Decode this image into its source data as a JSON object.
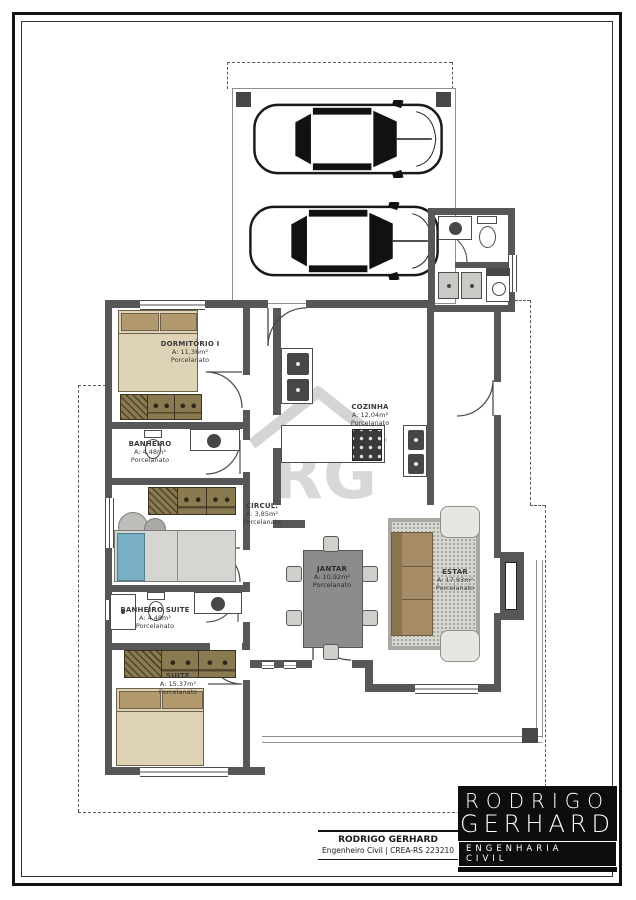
{
  "rooms": [
    {
      "name": "DORMITÓRIO I",
      "area": "A: 11,36m²",
      "floor": "Porcelanato"
    },
    {
      "name": "BANHEIRO",
      "area": "A: 4,48m²",
      "floor": "Porcelanato"
    },
    {
      "name": "CIRCUL.",
      "area": "A: 3,85m²",
      "floor": "Porcelanato"
    },
    {
      "name": "COZINHA",
      "area": "A: 12,04m²",
      "floor": "Porcelanato"
    },
    {
      "name": "JANTAR",
      "area": "A: 10,92m²",
      "floor": "Porcelanato"
    },
    {
      "name": "ESTAR",
      "area": "A: 17,93m²",
      "floor": "Porcelanato"
    },
    {
      "name": "BANHEIRO SUITE",
      "area": "A: 4,48m²",
      "floor": "Porcelanato"
    },
    {
      "name": "SUITE",
      "area": "A: 15,37m²",
      "floor": "Porcelanato"
    }
  ],
  "title_block": {
    "name": "RODRIGO GERHARD",
    "subtitle": "Engenheiro Civil | CREA-RS 223210"
  },
  "brand_logo": {
    "line1": "RODRIGO",
    "line2": "GERHARD",
    "line3": "ENGENHARIA CIVIL"
  },
  "watermark": {
    "letters": "RG"
  },
  "colors": {
    "wall": "#575757",
    "wood": "#8a7a52",
    "bed_beige": "#ded3b6",
    "pillow_brown": "#b29a6e",
    "accent_blue": "#79afc4",
    "sofa_brown": "#a58b66",
    "logo_bg": "#0d0d0d"
  }
}
